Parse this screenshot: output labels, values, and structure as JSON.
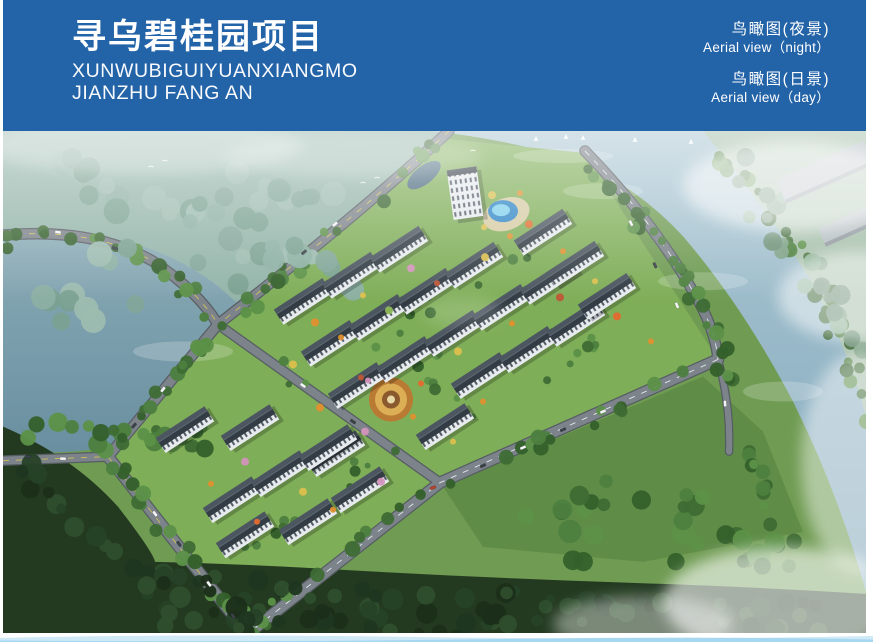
{
  "banner": {
    "bg": "#2363a8",
    "title": "寻乌碧桂园项目",
    "subtitle_line1": "XUNWUBIGUIYUANXIANGMO",
    "subtitle_line2": "JIANZHU FANG AN",
    "views": [
      {
        "cn": "鸟瞰图(夜景)",
        "en": "Aerial view（night）"
      },
      {
        "cn": "鸟瞰图(日景)",
        "en": "Aerial view（day）"
      }
    ]
  },
  "footer": {
    "wave_color_light": "#cfe9f6",
    "wave_color_mid": "#9fd4ef"
  },
  "scene": {
    "colors": {
      "base_meadow": "#6f9b52",
      "site_lawn": "#7fae58",
      "meadow_right": "#5f8c47",
      "haze_forest": "#93b4a9",
      "beyond_river": "#a7c0ab",
      "forest_dark": "#233a20",
      "road_fill": "#7c838a",
      "road_casing": "#565d63",
      "dash_yellow": "#d6c455",
      "dash_white": "#e9eef1",
      "lake_top": "#8aabb6",
      "lake_bottom": "#698fa0",
      "river_top": "#abc7d3",
      "river_bottom": "#82a8bb",
      "roof_light": "#4c5660",
      "roof_dark": "#333c45",
      "ridge": "#5d6872",
      "facade": "#e7ebee",
      "window": "#4e5763",
      "industrial": "#b4bdc1",
      "pool_outer": "#2f86c6",
      "pool_inner": "#7fd0ec",
      "deck": "#d6cba4",
      "canal": "#46677c"
    },
    "zones": [
      {
        "name": "base-meadow",
        "d": "M0,0H863V501H0Z",
        "fill": "#6f9b52"
      },
      {
        "name": "haze-forest",
        "d": "M0,0 H450 L215,196 Q100,235 0,258 Z",
        "fill": "#93b4a9"
      },
      {
        "name": "beyond-river",
        "d": "M690,0 H863 V310 Q818,205 758,112 Q728,52 690,0 Z",
        "fill": "#a7c0ab"
      },
      {
        "name": "river",
        "d": "M428,0 H700 Q755,65 805,145 Q845,215 863,285 V460 Q835,360 790,270 Q740,175 680,105 Q620,40 540,20 Q485,6 428,0 Z",
        "fill": "url(#riverG)"
      },
      {
        "name": "lake",
        "d": "M0,105 Q60,95 130,112 Q190,130 230,168 Q290,215 330,268 Q345,290 330,305 Q295,322 240,315 Q170,305 110,315 Q50,325 0,318 Z",
        "fill": "url(#lakeG)"
      },
      {
        "name": "meadow-right",
        "d": "M440,355 L700,245 L760,300 L800,400 L640,430 L480,415 Z",
        "fill": "#5f8c47"
      },
      {
        "name": "site-lawn",
        "d": "M215,193 L445,8 L582,22 L715,228 L437,351 L247,500 L105,325 Z",
        "fill": "#7fae58"
      },
      {
        "name": "forest-bottom",
        "d": "M0,295 Q70,325 115,375 Q150,420 152,430 Q240,432 340,438 Q500,447 660,452 Q770,456 863,462 V501 H0 Z",
        "fill": "#233a20"
      }
    ],
    "river_streaks": [
      [
        600,
        60,
        40,
        8
      ],
      [
        700,
        150,
        45,
        9
      ],
      [
        780,
        260,
        40,
        10
      ],
      [
        560,
        25,
        50,
        7
      ],
      [
        180,
        220,
        50,
        10
      ]
    ],
    "roads": [
      {
        "d": "M0,104 Q90,96 150,130 Q195,160 215,193",
        "w": 9,
        "dash": "y"
      },
      {
        "d": "M446,0 Q360,80 215,193",
        "w": 9,
        "dash": "y"
      },
      {
        "d": "M215,193 L105,325",
        "w": 9,
        "dash": ""
      },
      {
        "d": "M105,325 L247,505",
        "w": 10,
        "dash": "y"
      },
      {
        "d": "M0,329 L105,325",
        "w": 8,
        "dash": "y"
      },
      {
        "d": "M582,20 Q650,90 690,160 Q712,196 715,228",
        "w": 9,
        "dash": "w"
      },
      {
        "d": "M715,228 L437,351 L247,500",
        "w": 10,
        "dash": "w"
      },
      {
        "d": "M715,228 Q728,275 726,320",
        "w": 6,
        "dash": ""
      },
      {
        "d": "M215,193 L437,351",
        "w": 8,
        "dash": ""
      }
    ],
    "palettes": [
      [
        "#3e6c34",
        "#4d7f3f",
        "#5c9148",
        "#34602b"
      ],
      [
        "#1b2e19",
        "#264127",
        "#2f4e2d",
        "#1f3620"
      ],
      [
        "#8cb0a3",
        "#7aa191",
        "#9dbcb0",
        "#83a79a"
      ],
      [
        "#7da186",
        "#8db297",
        "#6d9077"
      ]
    ],
    "belts": [
      {
        "pts": [
          [
            446,
            4
          ],
          [
            330,
            105
          ],
          [
            218,
            192
          ]
        ],
        "n": 24,
        "r": [
          4,
          8
        ],
        "s": 10,
        "p": 0
      },
      {
        "pts": [
          [
            215,
            196
          ],
          [
            160,
            260
          ],
          [
            107,
            322
          ]
        ],
        "n": 16,
        "r": [
          4,
          8
        ],
        "s": 10,
        "p": 0
      },
      {
        "pts": [
          [
            112,
            330
          ],
          [
            180,
            420
          ],
          [
            248,
            500
          ]
        ],
        "n": 20,
        "r": [
          4,
          8
        ],
        "s": 9,
        "p": 0
      },
      {
        "pts": [
          [
            0,
            112
          ],
          [
            80,
            104
          ],
          [
            150,
            135
          ],
          [
            210,
            180
          ]
        ],
        "n": 18,
        "r": [
          4,
          8
        ],
        "s": 9,
        "p": 0
      },
      {
        "pts": [
          [
            20,
            300
          ],
          [
            90,
            305
          ],
          [
            160,
            300
          ],
          [
            230,
            310
          ],
          [
            60,
            318
          ]
        ],
        "n": 24,
        "r": [
          5,
          10
        ],
        "s": 12,
        "p": 0
      },
      {
        "pts": [
          [
            570,
            28
          ],
          [
            640,
            90
          ],
          [
            690,
            150
          ],
          [
            715,
            215
          ],
          [
            735,
            290
          ],
          [
            765,
            370
          ],
          [
            795,
            445
          ]
        ],
        "n": 46,
        "r": [
          4,
          8
        ],
        "s": 9,
        "p": 0
      },
      {
        "pts": [
          [
            705,
            10
          ],
          [
            765,
            75
          ],
          [
            815,
            150
          ],
          [
            847,
            230
          ],
          [
            862,
            310
          ]
        ],
        "n": 36,
        "r": [
          4,
          8
        ],
        "s": 9,
        "p": 0
      },
      {
        "pts": [
          [
            700,
            242
          ],
          [
            580,
            292
          ],
          [
            450,
            345
          ],
          [
            350,
            412
          ],
          [
            258,
            488
          ]
        ],
        "n": 26,
        "r": [
          4,
          8
        ],
        "s": 9,
        "p": 0
      },
      {
        "pts": [
          [
            500,
            385
          ],
          [
            570,
            375
          ],
          [
            640,
            355
          ],
          [
            700,
            385
          ],
          [
            770,
            420
          ],
          [
            660,
            415
          ],
          [
            540,
            415
          ]
        ],
        "n": 30,
        "r": [
          6,
          12
        ],
        "s": 16,
        "p": 0
      },
      {
        "pts": [
          [
            25,
            345
          ],
          [
            80,
            395
          ],
          [
            140,
            450
          ],
          [
            230,
            460
          ],
          [
            340,
            462
          ],
          [
            460,
            470
          ],
          [
            580,
            478
          ],
          [
            700,
            482
          ],
          [
            810,
            485
          ],
          [
            160,
            490
          ],
          [
            300,
            490
          ],
          [
            500,
            492
          ]
        ],
        "n": 110,
        "r": [
          5,
          11
        ],
        "s": 15,
        "p": 1
      },
      {
        "pts": [
          [
            30,
            30
          ],
          [
            110,
            55
          ],
          [
            190,
            85
          ],
          [
            270,
            115
          ],
          [
            350,
            145
          ],
          [
            90,
            120
          ],
          [
            40,
            180
          ],
          [
            150,
            170
          ],
          [
            230,
            45
          ],
          [
            320,
            75
          ]
        ],
        "n": 55,
        "r": [
          7,
          13
        ],
        "s": 18,
        "p": 2
      },
      {
        "pts": [
          [
            715,
            35
          ],
          [
            770,
            95
          ],
          [
            820,
            160
          ],
          [
            850,
            215
          ],
          [
            745,
            15
          ]
        ],
        "n": 22,
        "r": [
          5,
          10
        ],
        "s": 12,
        "p": 3
      },
      {
        "pts": [
          [
            260,
            220
          ],
          [
            300,
            260
          ],
          [
            380,
            200
          ],
          [
            460,
            160
          ],
          [
            520,
            130
          ],
          [
            420,
            240
          ],
          [
            480,
            300
          ],
          [
            380,
            320
          ],
          [
            300,
            380
          ],
          [
            240,
            420
          ],
          [
            560,
            240
          ],
          [
            600,
            200
          ]
        ],
        "n": 42,
        "r": [
          3,
          6
        ],
        "s": 10,
        "p": 0
      }
    ],
    "buildings": {
      "angle": -33,
      "w": 58,
      "h": 18,
      "slabs": [
        [
          300,
          170
        ],
        [
          348,
          144
        ],
        [
          396,
          118
        ],
        [
          327,
          212
        ],
        [
          375,
          186
        ],
        [
          423,
          160
        ],
        [
          471,
          134
        ],
        [
          354,
          254
        ],
        [
          402,
          228
        ],
        [
          450,
          202
        ],
        [
          498,
          176
        ],
        [
          546,
          150
        ],
        [
          333,
          322
        ],
        [
          477,
          244
        ],
        [
          525,
          218
        ],
        [
          573,
          192
        ],
        [
          229,
          368
        ],
        [
          277,
          342
        ],
        [
          325,
          316
        ],
        [
          442,
          295
        ],
        [
          182,
          298
        ],
        [
          247,
          296
        ],
        [
          357,
          358
        ],
        [
          242,
          403
        ],
        [
          305,
          390
        ],
        [
          540,
          101
        ],
        [
          572,
          133
        ],
        [
          604,
          165
        ]
      ],
      "tower": {
        "x": 462,
        "y": 62,
        "w": 30,
        "h": 50
      }
    },
    "industrial": [
      {
        "x": 822,
        "y": 41,
        "w": 96,
        "h": 26,
        "a": -24
      },
      {
        "x": 849,
        "y": 93,
        "w": 66,
        "h": 20,
        "a": -24
      }
    ],
    "features": {
      "pool": {
        "x": 500,
        "y": 80
      },
      "garden": {
        "x": 388,
        "y": 268
      },
      "canal": {
        "x": 421,
        "y": 44
      }
    },
    "tree_palette": [
      "#e0902f",
      "#dcc04d",
      "#d493bd",
      "#bf5636",
      "#8fba57",
      "#e4692f"
    ],
    "color_trees": [
      [
        312,
        191,
        4,
        0
      ],
      [
        360,
        164,
        3,
        1
      ],
      [
        408,
        137,
        4,
        2
      ],
      [
        290,
        233,
        4,
        1
      ],
      [
        338,
        206,
        3,
        0
      ],
      [
        386,
        179,
        4,
        4
      ],
      [
        434,
        152,
        3,
        3
      ],
      [
        482,
        126,
        4,
        1
      ],
      [
        317,
        276,
        4,
        0
      ],
      [
        365,
        249,
        3,
        2
      ],
      [
        455,
        220,
        4,
        1
      ],
      [
        509,
        192,
        3,
        0
      ],
      [
        557,
        166,
        4,
        3
      ],
      [
        362,
        300,
        4,
        2
      ],
      [
        410,
        285,
        3,
        0
      ],
      [
        418,
        252,
        3,
        5
      ],
      [
        358,
        246,
        3,
        3
      ],
      [
        489,
        64,
        4,
        1
      ],
      [
        517,
        62,
        3,
        0
      ],
      [
        526,
        93,
        4,
        5
      ],
      [
        481,
        96,
        3,
        1
      ],
      [
        507,
        105,
        3,
        0
      ],
      [
        242,
        330,
        4,
        2
      ],
      [
        208,
        352,
        3,
        0
      ],
      [
        300,
        360,
        4,
        1
      ],
      [
        254,
        390,
        3,
        5
      ],
      [
        330,
        378,
        3,
        0
      ],
      [
        378,
        350,
        4,
        2
      ],
      [
        560,
        120,
        3,
        0
      ],
      [
        592,
        150,
        3,
        1
      ],
      [
        614,
        185,
        4,
        5
      ],
      [
        648,
        210,
        3,
        0
      ],
      [
        450,
        310,
        3,
        1
      ],
      [
        480,
        270,
        3,
        0
      ]
    ],
    "cars": [
      [
        55,
        101,
        8,
        "w"
      ],
      [
        112,
        117,
        18,
        "d"
      ],
      [
        332,
        93,
        -40,
        "w"
      ],
      [
        301,
        121,
        -40,
        "d"
      ],
      [
        160,
        258,
        131,
        "w"
      ],
      [
        131,
        294,
        131,
        "d"
      ],
      [
        152,
        382,
        53,
        "w"
      ],
      [
        176,
        412,
        53,
        "d"
      ],
      [
        206,
        452,
        53,
        "w"
      ],
      [
        230,
        484,
        53,
        "d"
      ],
      [
        25,
        325,
        2,
        "d"
      ],
      [
        60,
        327,
        2,
        "w"
      ],
      [
        628,
        92,
        62,
        "w"
      ],
      [
        652,
        134,
        64,
        "d"
      ],
      [
        674,
        174,
        67,
        "w"
      ],
      [
        600,
        280,
        -24,
        "w"
      ],
      [
        560,
        298,
        -23,
        "d"
      ],
      [
        520,
        316,
        -23,
        "w"
      ],
      [
        480,
        334,
        -24,
        "d"
      ],
      [
        430,
        356,
        -20,
        "r"
      ],
      [
        722,
        272,
        86,
        "w"
      ],
      [
        300,
        254,
        35,
        "w"
      ],
      [
        350,
        290,
        35,
        "d"
      ]
    ],
    "boats": [
      [
        533,
        9
      ],
      [
        563,
        7
      ],
      [
        580,
        8
      ],
      [
        632,
        10
      ],
      [
        688,
        12
      ]
    ],
    "birds": [
      [
        148,
        36
      ],
      [
        162,
        30
      ],
      [
        360,
        52
      ],
      [
        374,
        47
      ],
      [
        470,
        20
      ]
    ],
    "mists": [
      {
        "x": 790,
        "y": 55,
        "rx": 110,
        "ry": 45,
        "o": 0.55
      },
      {
        "x": 855,
        "y": 165,
        "rx": 80,
        "ry": 45,
        "o": 0.5
      },
      {
        "x": 858,
        "y": 330,
        "rx": 60,
        "ry": 110,
        "o": 0.45
      },
      {
        "x": 780,
        "y": 470,
        "rx": 120,
        "ry": 55,
        "o": 0.6
      },
      {
        "x": 640,
        "y": 492,
        "rx": 90,
        "ry": 28,
        "o": 0.4
      },
      {
        "x": 140,
        "y": 15,
        "rx": 160,
        "ry": 28,
        "o": 0.3
      },
      {
        "x": 350,
        "y": 25,
        "rx": 130,
        "ry": 22,
        "o": 0.22
      },
      {
        "x": 460,
        "y": 180,
        "rx": 40,
        "ry": 15,
        "o": 0.15
      }
    ]
  }
}
